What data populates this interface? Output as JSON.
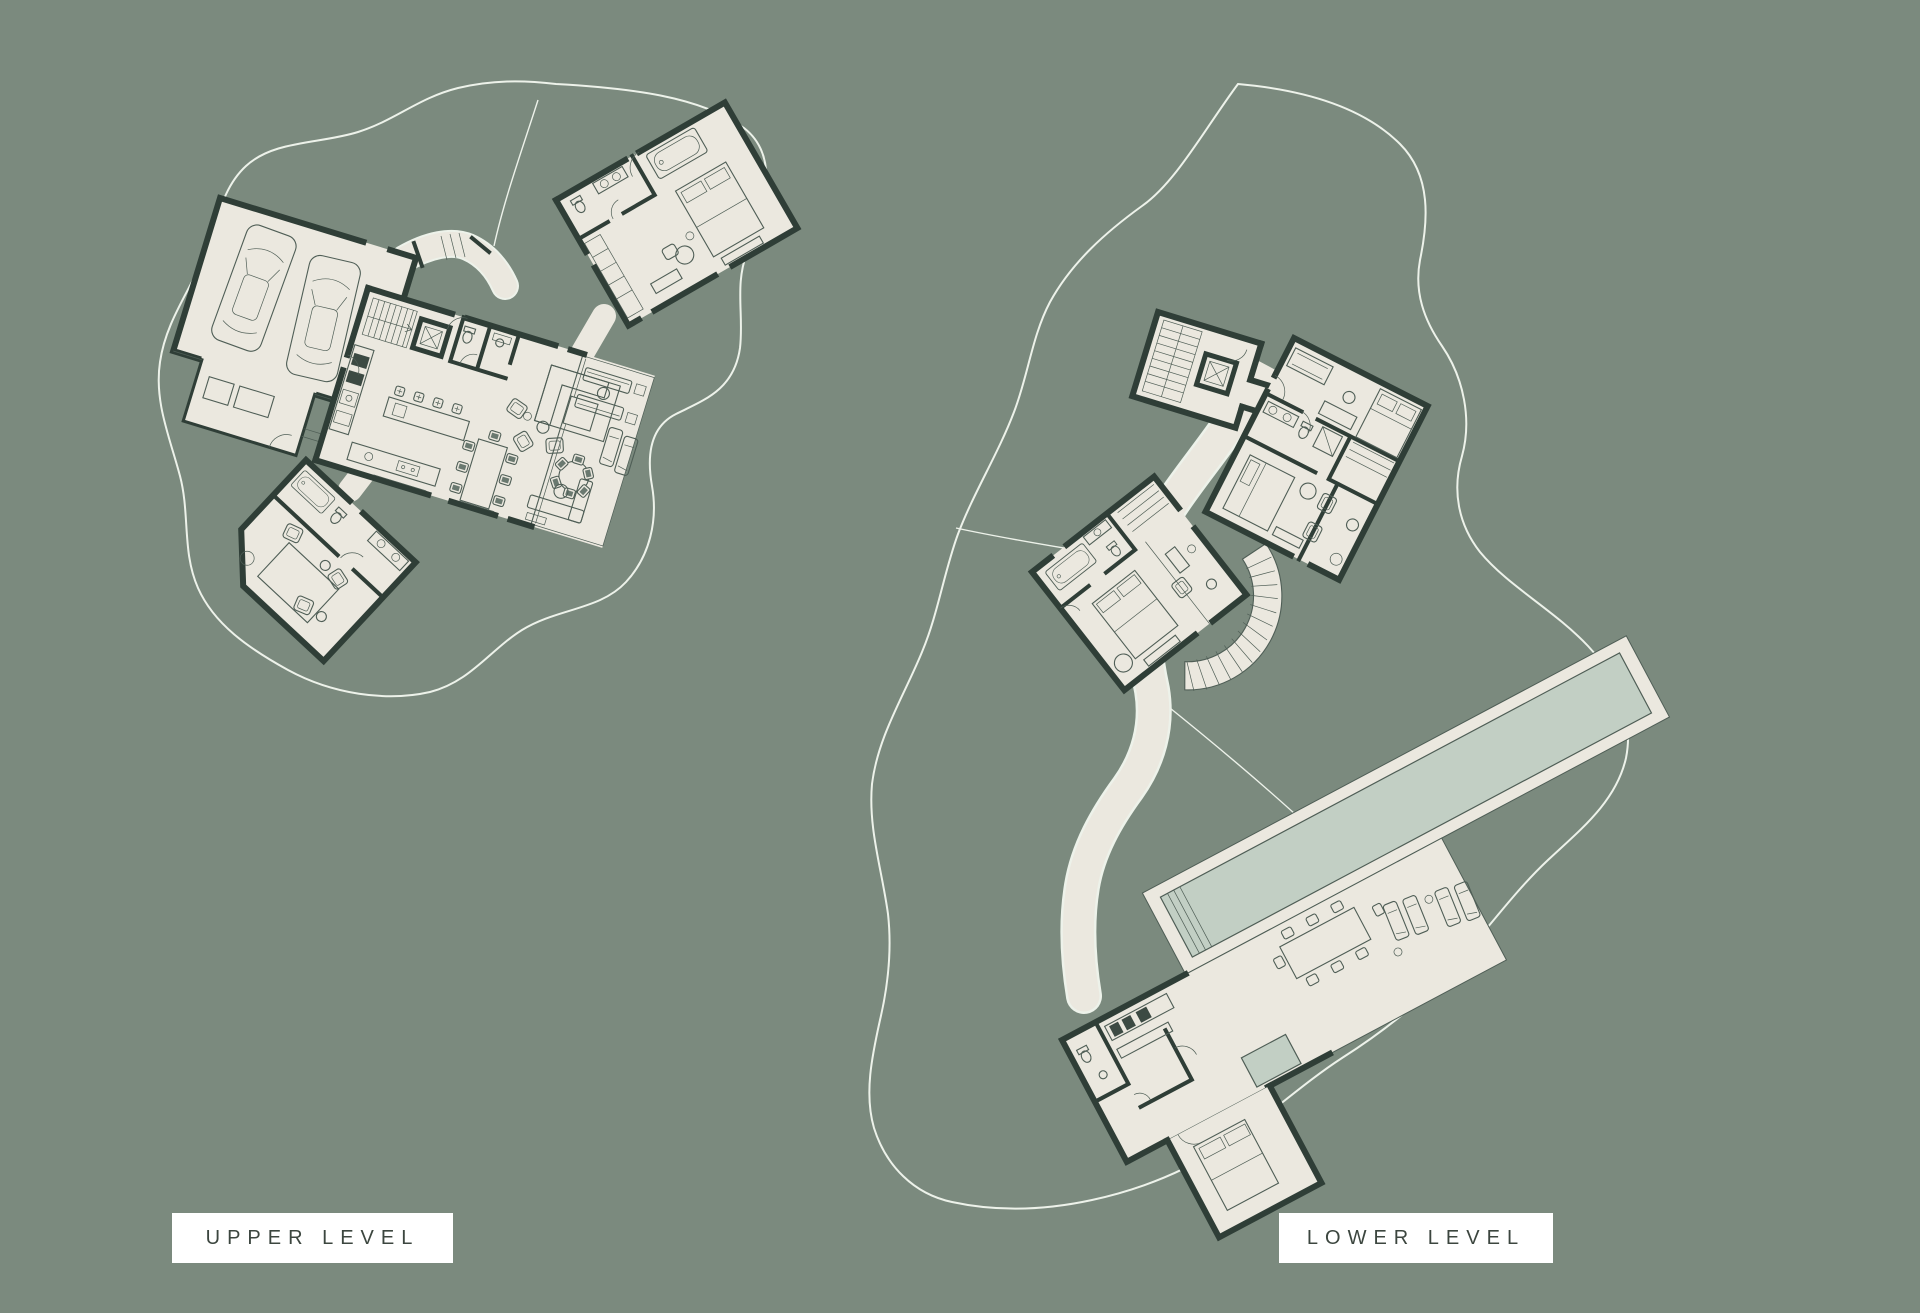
{
  "document_title": "Residence Floor Plans",
  "plans": [
    {
      "id": "upper",
      "label": "UPPER LEVEL"
    },
    {
      "id": "lower",
      "label": "LOWER LEVEL"
    }
  ],
  "colors": {
    "background": "#7b8a7e",
    "floor": "#ebe8df",
    "wall": "#2f3e37",
    "furniture_line": "#4f5e56",
    "pool": "#c2cfc4",
    "site_contour": "#edf2ea",
    "label_bg": "#ffffff",
    "label_text": "#3c463f"
  }
}
